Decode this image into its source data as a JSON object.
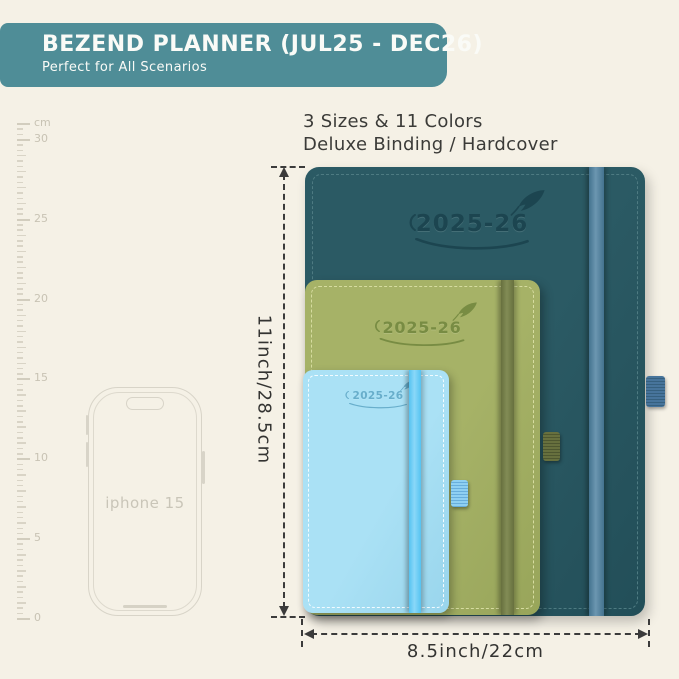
{
  "page": {
    "background": "#F5F1E6"
  },
  "header": {
    "title": "BEZEND PLANNER (JUL25 - DEC26)",
    "subtitle": "Perfect for All Scenarios",
    "bg_color": "#4F8D97",
    "text_color": "#FAFBF7"
  },
  "features": {
    "line1": "3 Sizes & 11 Colors",
    "line2": "Deluxe Binding / Hardcover"
  },
  "ruler": {
    "unit": "cm",
    "labels": [
      0,
      5,
      10,
      15,
      20,
      25,
      30
    ],
    "max_cm": 31,
    "label_every": 5
  },
  "phone": {
    "label": "iphone 15"
  },
  "planners": [
    {
      "size": "large",
      "year": "2025-26",
      "cover_color": "#2B5A64",
      "cover_color_dark": "#224E58",
      "stitch_color": "#4E7B82",
      "logo_color": "#1C4550",
      "band_color": "#44738F",
      "band_color_light": "#6B96B0",
      "loop_color": "#47749B",
      "loop_rib_color": "#36607F"
    },
    {
      "size": "medium",
      "year": "2025-26",
      "cover_color": "#A6B267",
      "cover_color_dark": "#98A55A",
      "stitch_color": "#D6DCA0",
      "logo_color": "#788C43",
      "band_color": "#67703E",
      "band_color_light": "#828C55",
      "loop_color": "#67703E",
      "loop_rib_color": "#4E5730"
    },
    {
      "size": "small",
      "year": "2025-26",
      "cover_color": "#AAE1F5",
      "cover_color_dark": "#99D5EC",
      "stitch_color": "#F2FBFF",
      "logo_color": "#68AECB",
      "band_color": "#55C3F1",
      "band_color_light": "#8AD8F8",
      "loop_color": "#8FD0F2",
      "loop_rib_color": "#68AEDC"
    }
  ],
  "dimensions": {
    "height_label": "11inch/28.5cm",
    "width_label": "8.5inch/22cm"
  }
}
